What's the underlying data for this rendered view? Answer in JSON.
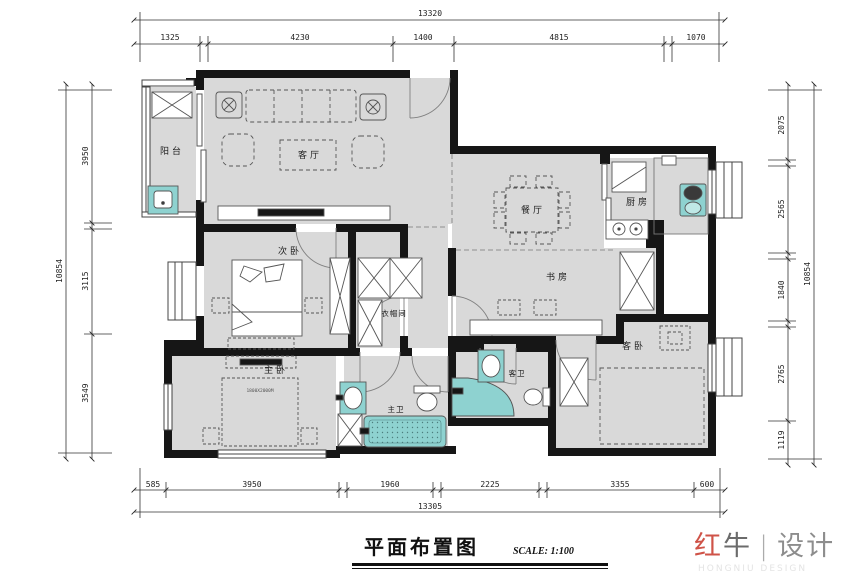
{
  "title": {
    "text": "平面布置图",
    "scale": "SCALE: 1:100"
  },
  "logo": {
    "brand_red": "红",
    "brand_dark": "牛",
    "divider": "|",
    "name": "设计",
    "subtitle": "HONGNIU DESIGN"
  },
  "rooms": {
    "balcony": "阳台",
    "living": "客厅",
    "dining": "餐厅",
    "kitchen": "厨房",
    "bedroom2": "次卧",
    "study": "书房",
    "cloakroom": "衣帽间",
    "master": "主卧",
    "master_bath": "主卫",
    "guest_bath": "客卫",
    "guest_bedroom": "客卧"
  },
  "annotations": {
    "bed_size": "1800X2000M"
  },
  "dimensions": {
    "top": {
      "total": "13320",
      "segments": [
        "1325",
        "4230",
        "1400",
        "4815",
        "1070"
      ]
    },
    "bottom": {
      "total": "13305",
      "segments": [
        "585",
        "3950",
        "1960",
        "2225",
        "3355",
        "600"
      ]
    },
    "left": {
      "total": "10854",
      "segments": [
        "3950",
        "3115",
        "3549"
      ]
    },
    "right": {
      "total": "10854",
      "segments": [
        "2075",
        "2565",
        "1840",
        "2765",
        "1119"
      ]
    }
  },
  "colors": {
    "wall": "#161616",
    "floor": "#d9d9d9",
    "fixture": "#8ed2d0",
    "accent_red": "#cf5348"
  }
}
